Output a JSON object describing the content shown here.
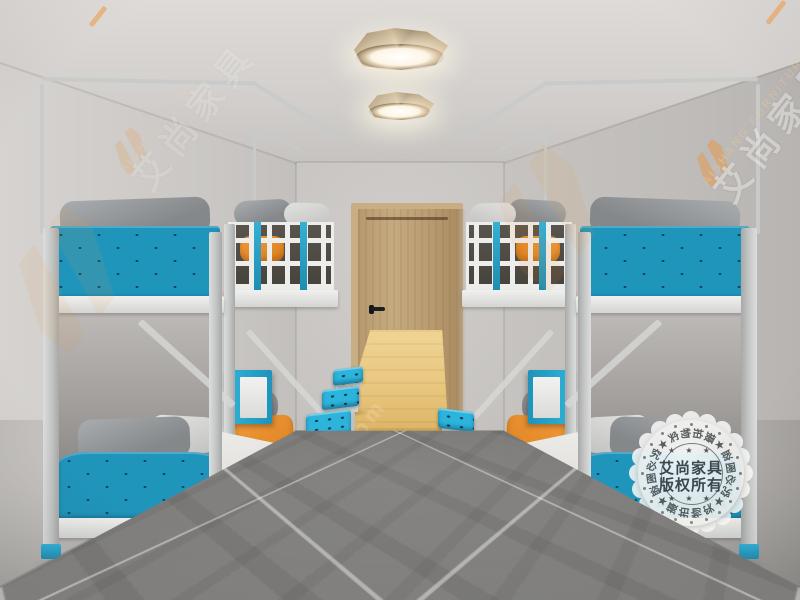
{
  "scene": {
    "description": "3D showroom render of a student dormitory: four white-steel bunk beds with teal perforated panels, grey and orange pillows, a long wooden dining table with eight blue perforated stools, wooden door, two faceted wooden ceiling lights, grey marble tile floor",
    "bunk_bed_count": "4",
    "stool_count": "6",
    "ceiling_light_count": "2"
  },
  "watermark": {
    "brand_cn": "艾尚家具",
    "brand_en": "AISHANG FURNITURE",
    "logo": "as-monogram-icon",
    "floor_url": "www.35b65.com"
  },
  "stamp": {
    "center_line1": "艾尚家具",
    "center_line2": "版权所有",
    "ring_text": "★盗图必究★实物拍摄★盗图必究★实物拍摄",
    "stars_row": "★ ★ ★"
  },
  "palette": {
    "teal_panel": "#2095bc",
    "teal_bright": "#2db4dc",
    "orange_pillow": "#ec8f2e",
    "door_wood": "#bb9d73",
    "table_wood": "#e7c67e",
    "wall_grey": "#cdcac7",
    "floor_grey": "#7b7a78"
  }
}
